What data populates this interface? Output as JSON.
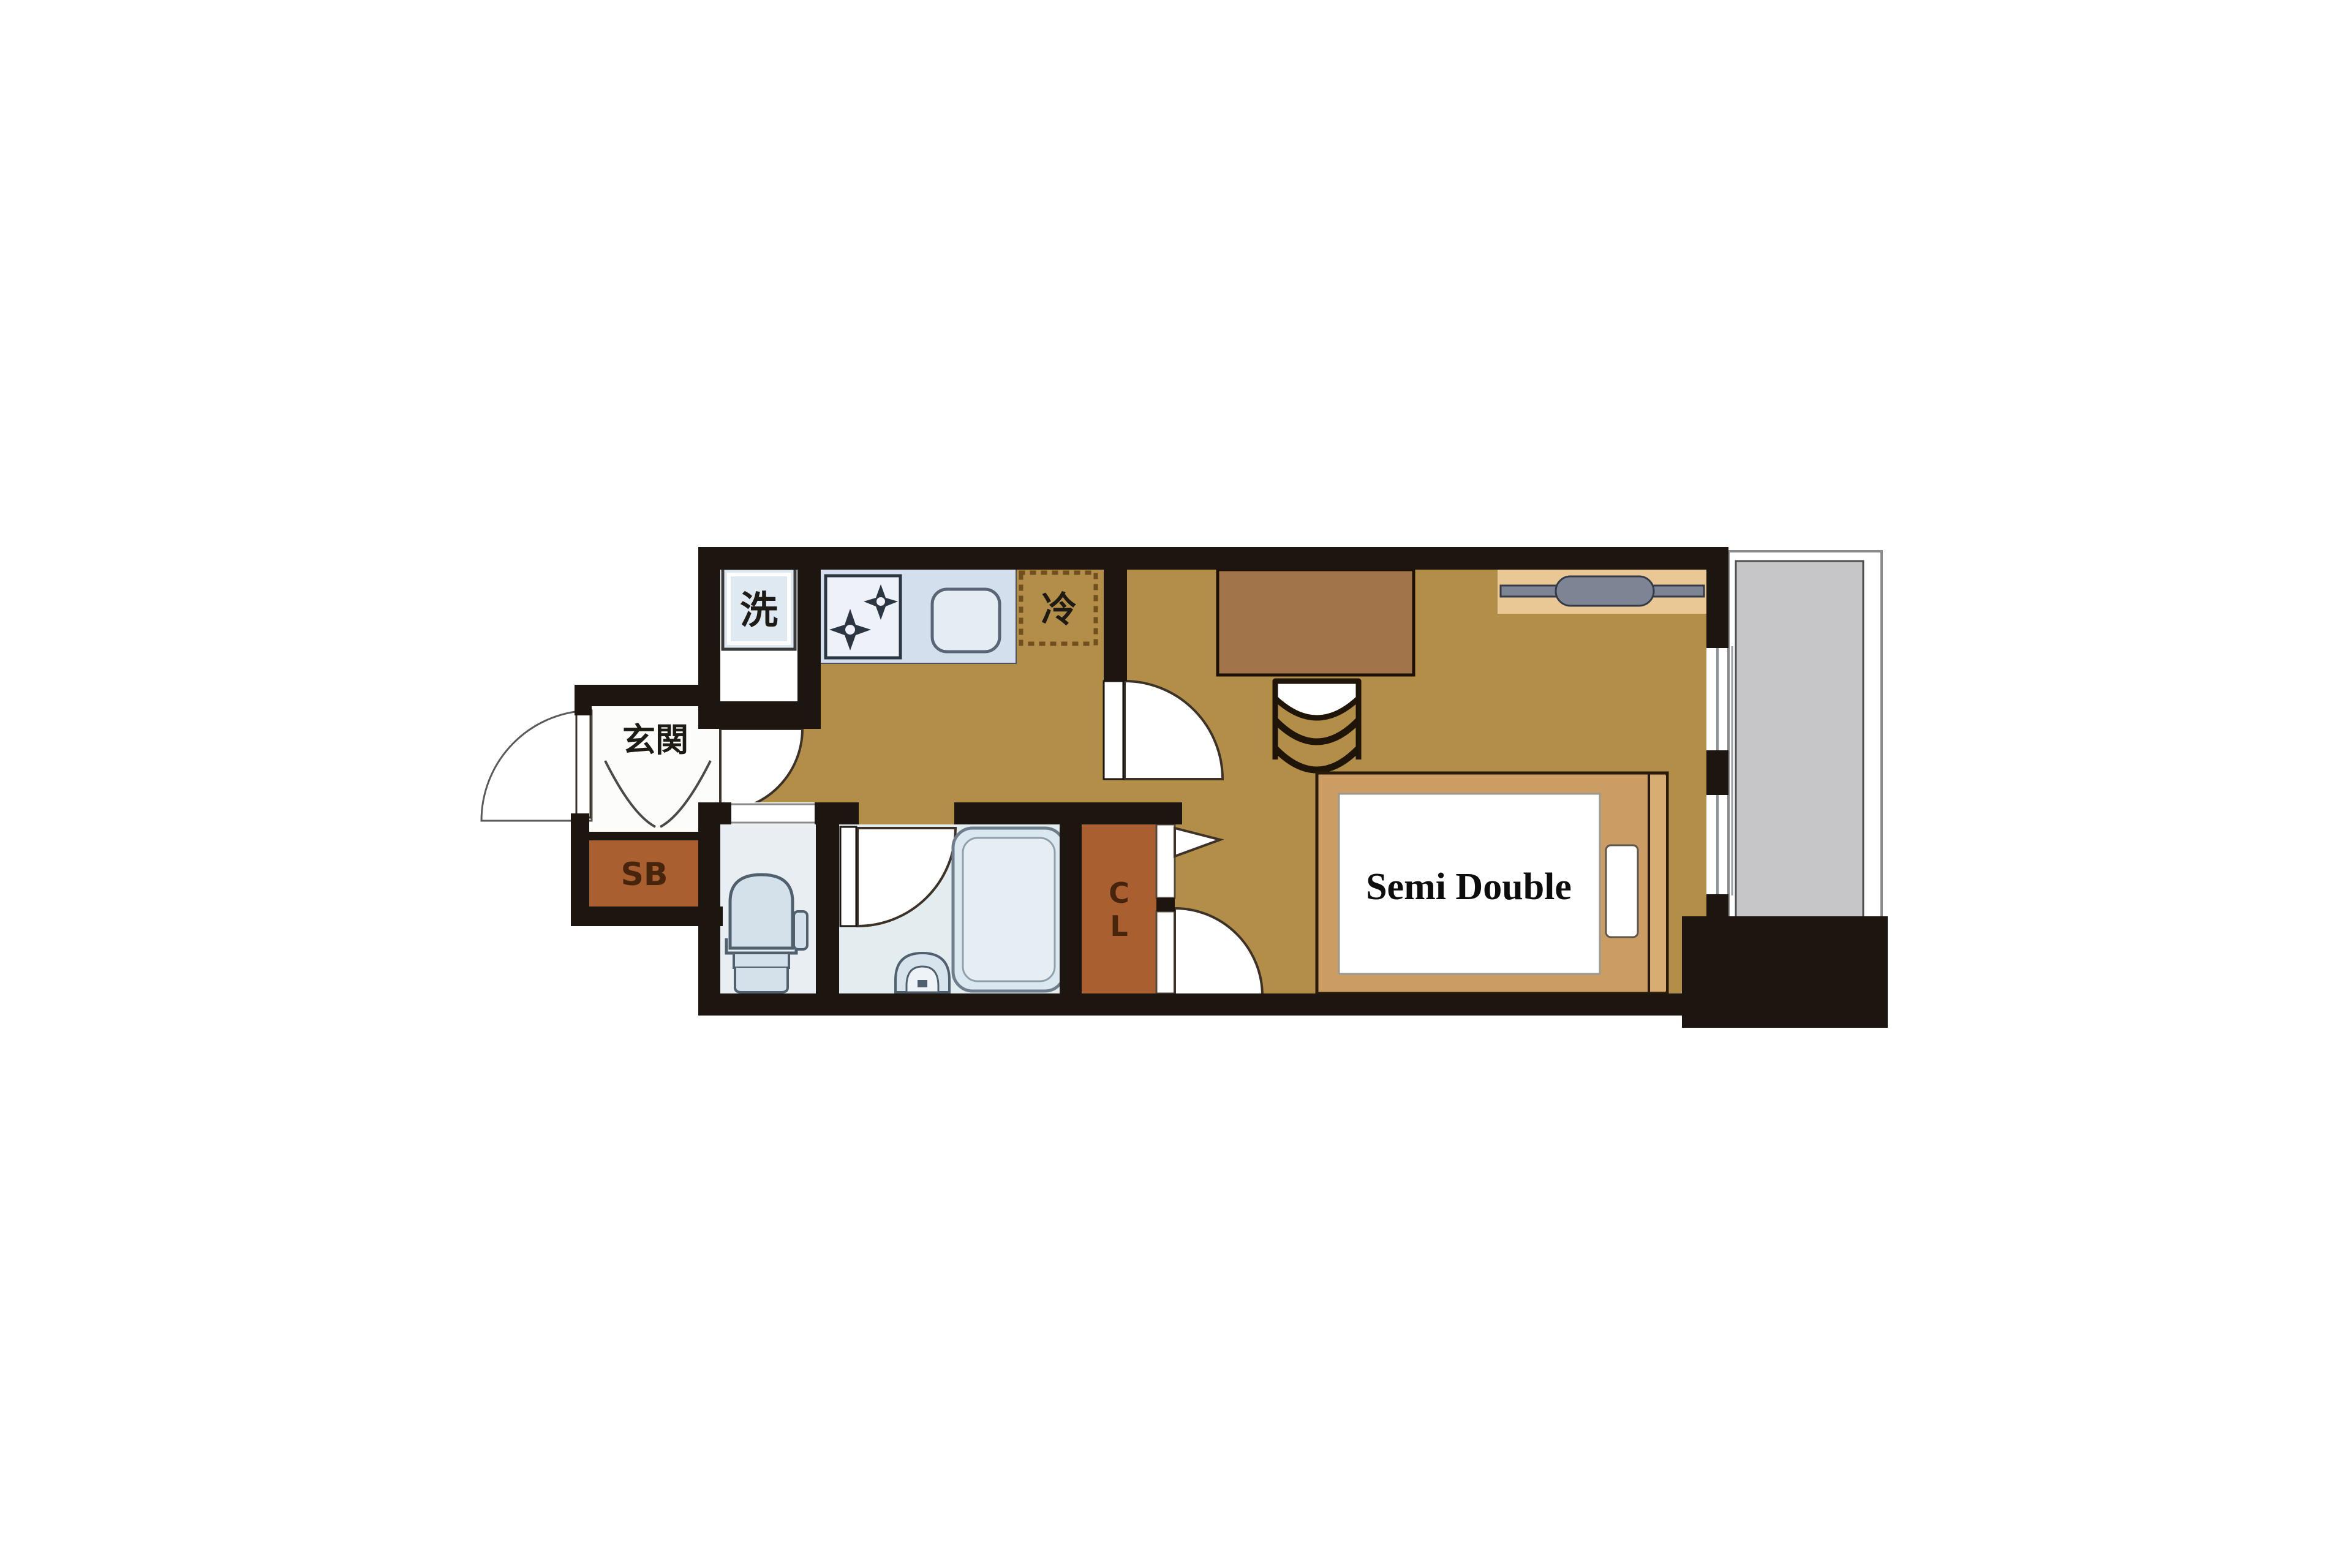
{
  "title": "1K apartment floor plan",
  "labels": {
    "washing_machine": "洗",
    "refrigerator": "冷",
    "entrance": "玄関",
    "shoe_box": "SB",
    "closet": "CL",
    "closet_chars": [
      "C",
      "L"
    ],
    "bed": "Semi Double"
  },
  "colors": {
    "wall": "#1c1510",
    "floor": "#b28e49",
    "corridor": "#ffffff",
    "desk": "#a2744a",
    "bed_frame": "#cb9c63",
    "bed_headboard": "#d8ad74",
    "mattress": "#ffffff",
    "shoe_box": "#a95f2f",
    "closet": "#a95f2f",
    "kitchen_counter": "#d4dfee",
    "stove": "#eef2f8",
    "sink": "#e4ecf4",
    "bathroom_floor": "#e3ecee",
    "toilet_floor": "#e8eef2",
    "fixture_fill": "#d5e1ea",
    "fixture_stroke": "#51606e",
    "balcony": "#c6c6c8",
    "hanger_shelf": "#e9c896",
    "hanger_pipe": "#7d8595",
    "fridge_dash": "#6f4f1e"
  }
}
